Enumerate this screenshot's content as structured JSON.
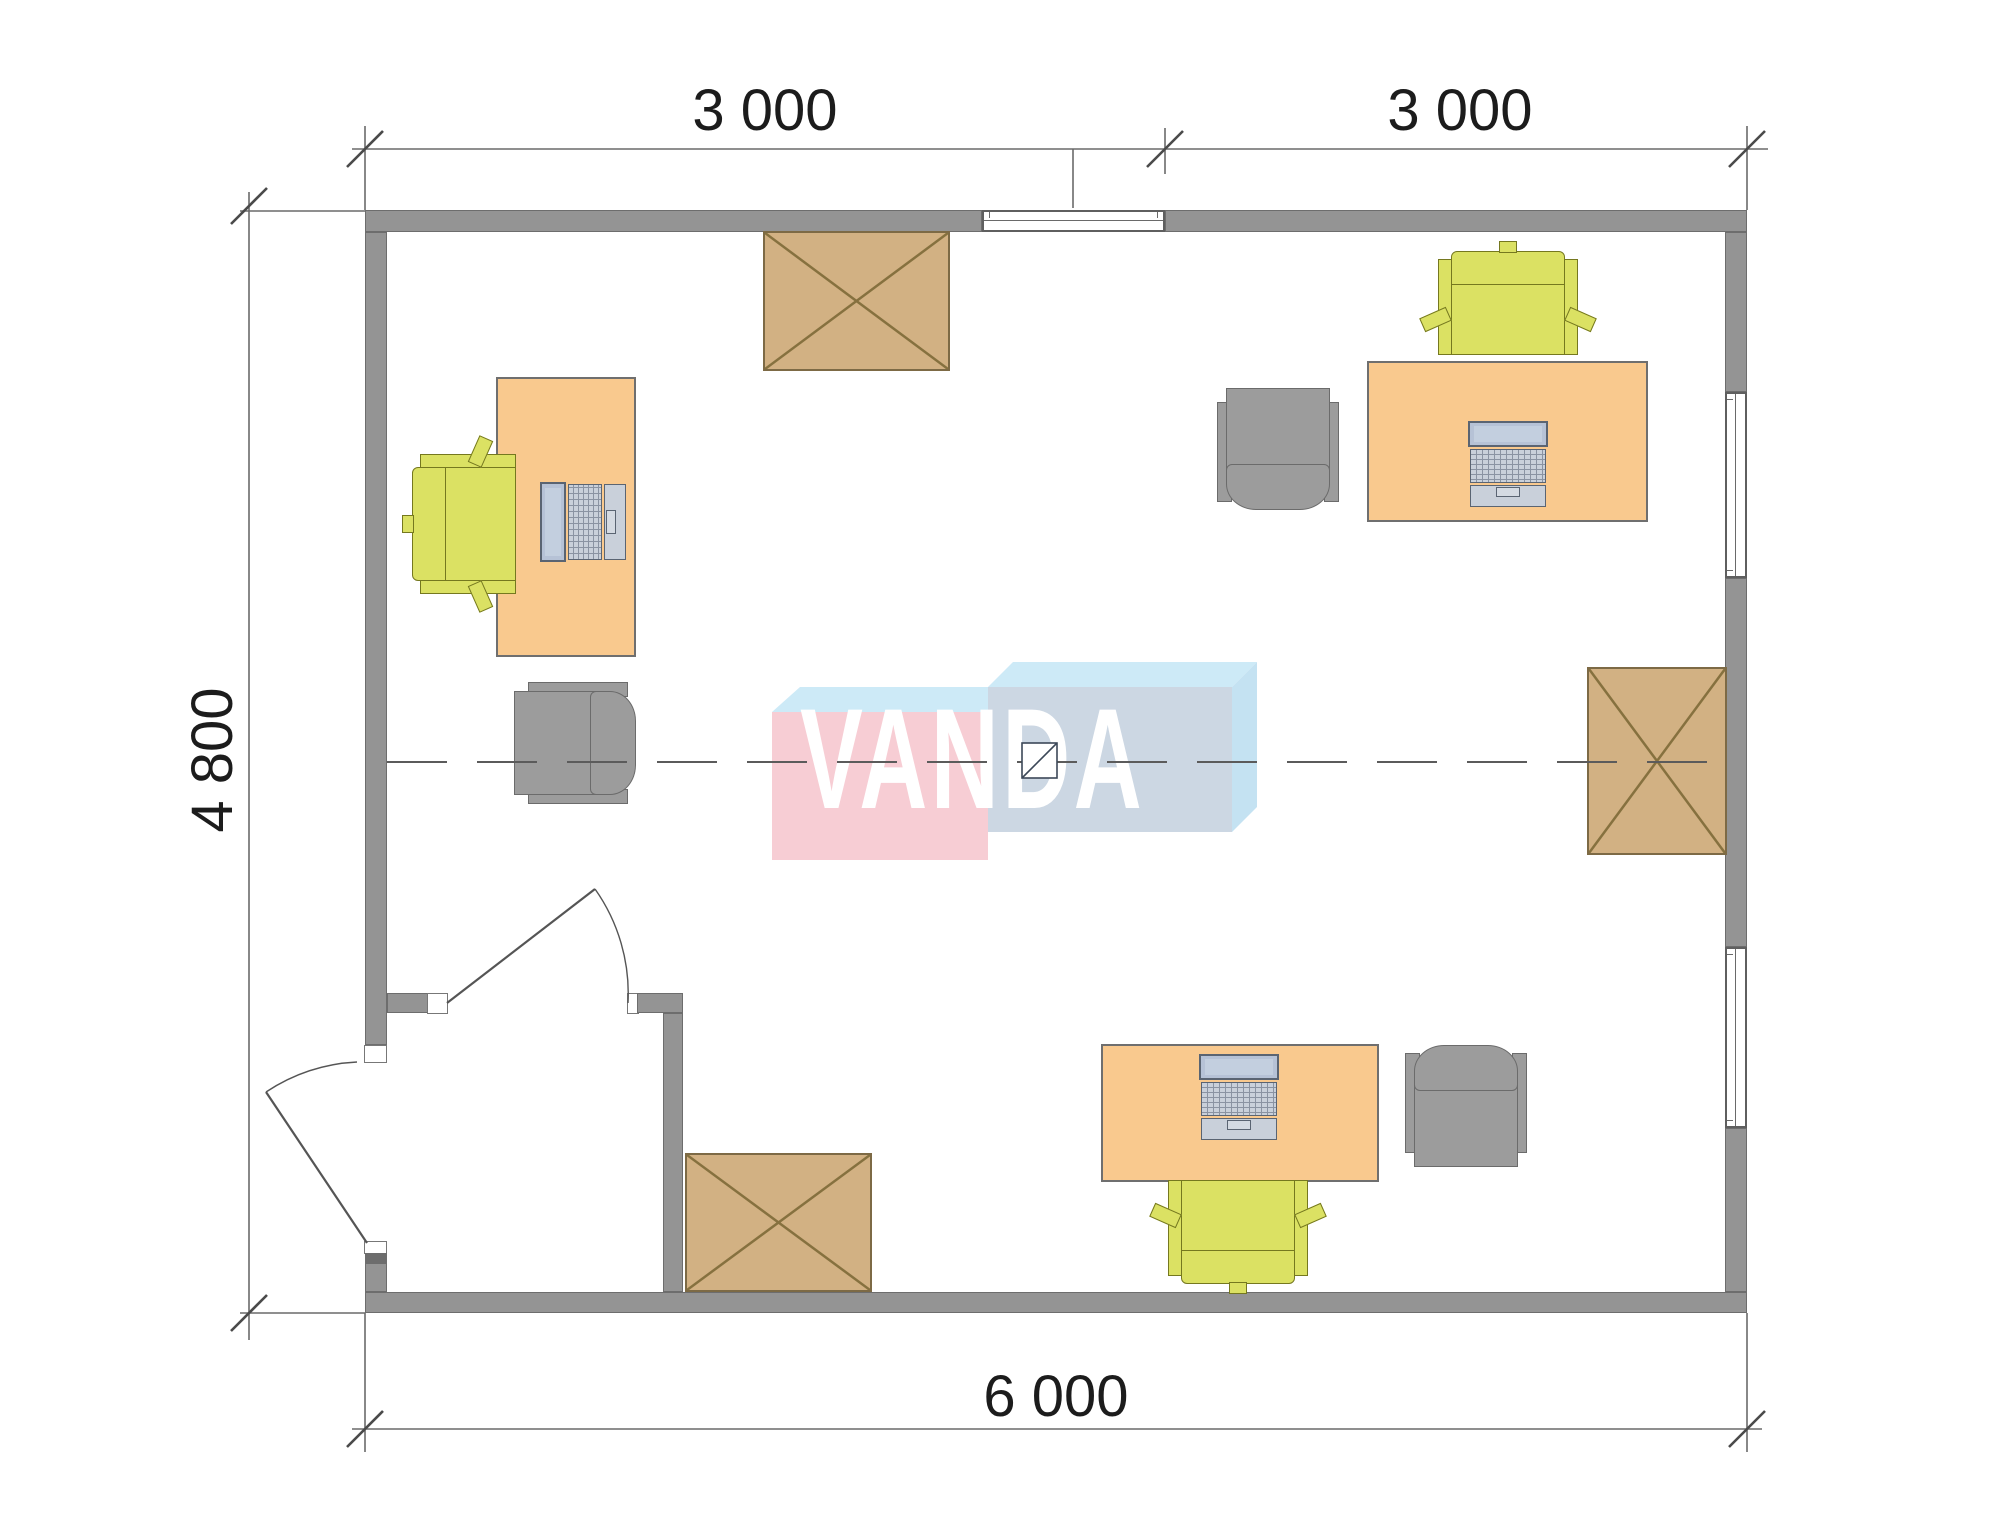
{
  "title": "office-floor-plan",
  "dimensions": {
    "top": [
      "3 000",
      "3 000"
    ],
    "left": "4 800",
    "bottom": "6 000"
  },
  "watermark": {
    "text": "VANDA"
  },
  "colors": {
    "wall": "#949494",
    "wall_dark": "#6d6d6d",
    "desk": "#f9c98e",
    "desk_border": "#6f6f6f",
    "chair_green": "#dbe163",
    "chair_green_border": "#75781f",
    "chair_gray": "#9c9c9c",
    "chair_gray_border": "#6b6b6b",
    "cabinet": "#d2b183",
    "cabinet_line": "#86713f",
    "laptop_screen": "#b6c2d6",
    "laptop_body": "#c9d0da",
    "logo_pink": "#f7cdd4",
    "logo_blue": "#ccd7e3",
    "logo_light": "#cdeaf7",
    "logo_light2": "#c4e2f2",
    "logo_text": "#ffffff",
    "line": "#555555",
    "dim_text": "#1c1c1c"
  },
  "furniture": {
    "workstations": [
      {
        "id": "left",
        "items": [
          "desk",
          "laptop",
          "green-task-chair",
          "gray-armchair"
        ]
      },
      {
        "id": "top-right",
        "items": [
          "desk",
          "laptop",
          "green-task-chair",
          "gray-armchair"
        ]
      },
      {
        "id": "bottom-right",
        "items": [
          "desk",
          "laptop",
          "green-task-chair",
          "gray-armchair"
        ]
      }
    ],
    "storage_cabinets": 3,
    "windows": 3,
    "doors": 2
  }
}
